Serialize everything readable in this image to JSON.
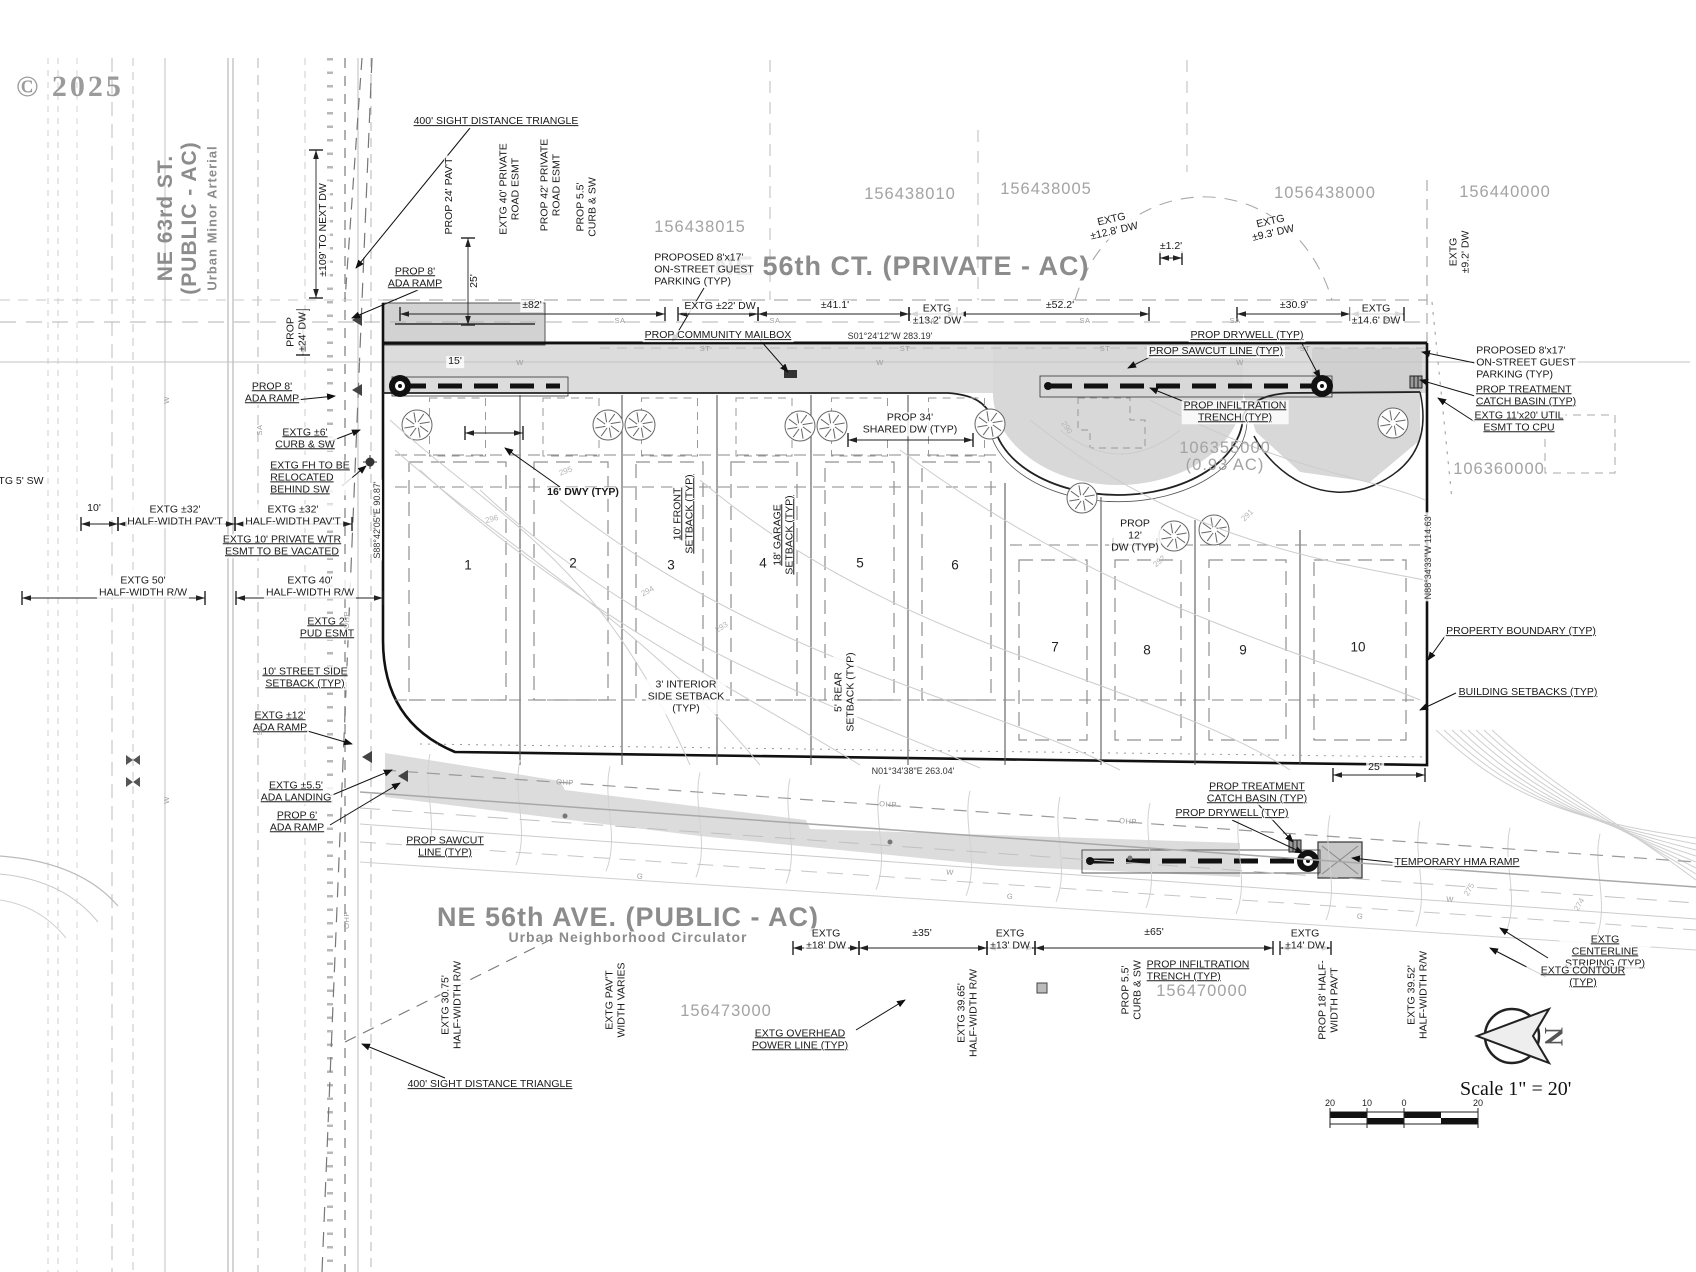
{
  "drawing": {
    "copyright": "© 2025",
    "scale_text": "Scale  1\" = 20'",
    "north_letter": "N"
  },
  "street_labels": [
    {
      "t": "NE 63rd ST.",
      "x": 166,
      "y": 218,
      "r": -90,
      "s": 21
    },
    {
      "t": "(PUBLIC - AC)",
      "x": 190,
      "y": 218,
      "r": -90,
      "s": 21
    },
    {
      "t": "Urban Minor Arterial",
      "x": 213,
      "y": 218,
      "r": -90,
      "s": 13
    },
    {
      "t": "NE 56th CT. (PRIVATE - AC)",
      "x": 902,
      "y": 266,
      "r": 0,
      "s": 27
    },
    {
      "t": "NE 56th AVE. (PUBLIC - AC)",
      "x": 628,
      "y": 917,
      "r": 0,
      "s": 27
    },
    {
      "t": "Urban Neighborhood Circulator",
      "x": 628,
      "y": 938,
      "r": 0,
      "s": 14
    }
  ],
  "parcel_labels": [
    {
      "t": "156438015",
      "x": 700,
      "y": 227
    },
    {
      "t": "156438010",
      "x": 910,
      "y": 194
    },
    {
      "t": "156438005",
      "x": 1046,
      "y": 189
    },
    {
      "t": "1056438000",
      "x": 1325,
      "y": 193
    },
    {
      "t": "156440000",
      "x": 1505,
      "y": 192
    },
    {
      "t": "106355000",
      "x": 1225,
      "y": 448
    },
    {
      "t": "(0.93 AC)",
      "x": 1225,
      "y": 465
    },
    {
      "t": "106360000",
      "x": 1499,
      "y": 469
    },
    {
      "t": "156473000",
      "x": 726,
      "y": 1011
    },
    {
      "t": "156470000",
      "x": 1202,
      "y": 991
    }
  ],
  "lot_labels": [
    {
      "t": "1",
      "x": 468,
      "y": 565
    },
    {
      "t": "2",
      "x": 573,
      "y": 563
    },
    {
      "t": "3",
      "x": 671,
      "y": 565
    },
    {
      "t": "4",
      "x": 763,
      "y": 563
    },
    {
      "t": "5",
      "x": 860,
      "y": 563
    },
    {
      "t": "6",
      "x": 955,
      "y": 565
    },
    {
      "t": "7",
      "x": 1055,
      "y": 647
    },
    {
      "t": "8",
      "x": 1147,
      "y": 650
    },
    {
      "t": "9",
      "x": 1243,
      "y": 650
    },
    {
      "t": "10",
      "x": 1358,
      "y": 647
    }
  ],
  "bearing_labels": [
    {
      "t": "S01°24'12\"W 283.19'",
      "x": 890,
      "y": 336,
      "r": 0
    },
    {
      "t": "S88°42'05\"E 90.87'",
      "x": 377,
      "y": 520,
      "r": -90
    },
    {
      "t": "N88°34'33\"W 114.63'",
      "x": 1428,
      "y": 557,
      "r": -90
    },
    {
      "t": "N01°34'38\"E 263.04'",
      "x": 913,
      "y": 771,
      "r": 0
    }
  ],
  "callout_labels": [
    {
      "t": "400' SIGHT DISTANCE TRIANGLE",
      "x": 496,
      "y": 122,
      "u": 1
    },
    {
      "t": "PROP 24' PAV'T",
      "x": 450,
      "y": 196,
      "r": -90
    },
    {
      "t": "EXTG 40' PRIVATE\nROAD ESMT",
      "x": 510,
      "y": 189,
      "r": -90
    },
    {
      "t": "PROP 42' PRIVATE\nROAD ESMT",
      "x": 551,
      "y": 185,
      "r": -90
    },
    {
      "t": "PROP 5.5'\nCURB & SW",
      "x": 587,
      "y": 207,
      "r": -90
    },
    {
      "t": "±109' TO NEXT DW",
      "x": 324,
      "y": 230,
      "r": -90
    },
    {
      "t": "PROP\n±24' DW",
      "x": 297,
      "y": 332,
      "r": -90
    },
    {
      "t": "PROP 8'\nADA RAMP",
      "x": 415,
      "y": 278,
      "u": 1
    },
    {
      "t": "PROPOSED 8'x17'\nON-STREET GUEST\nPARKING (TYP)",
      "x": 704,
      "y": 270,
      "a": "l"
    },
    {
      "t": "PROP COMMUNITY MAILBOX",
      "x": 718,
      "y": 336,
      "u": 1
    },
    {
      "t": "PROP DRYWELL (TYP)",
      "x": 1247,
      "y": 336,
      "u": 1
    },
    {
      "t": "PROP SAWCUT LINE (TYP)",
      "x": 1216,
      "y": 352,
      "u": 1
    },
    {
      "t": "PROP INFILTRATION\nTRENCH (TYP)",
      "x": 1235,
      "y": 412,
      "u": 1
    },
    {
      "t": "PROPOSED 8'x17'\nON-STREET GUEST\nPARKING (TYP)",
      "x": 1526,
      "y": 363,
      "a": "l"
    },
    {
      "t": "PROP TREATMENT\nCATCH BASIN (TYP)",
      "x": 1526,
      "y": 396,
      "u": 1,
      "a": "l"
    },
    {
      "t": "EXTG 11'x20' UTIL\nESMT TO CPU",
      "x": 1519,
      "y": 422,
      "u": 1
    },
    {
      "t": "PROP 8'\nADA RAMP",
      "x": 272,
      "y": 393,
      "u": 1
    },
    {
      "t": "EXTG ±6'\nCURB & SW",
      "x": 305,
      "y": 439,
      "u": 1
    },
    {
      "t": "TG 5' SW",
      "x": 21,
      "y": 482
    },
    {
      "t": "EXTG FH TO BE\nRELOCATED\nBEHIND SW",
      "x": 310,
      "y": 478,
      "u": 1,
      "a": "l"
    },
    {
      "t": "EXTG ±32'\nHALF-WIDTH PAV'T",
      "x": 175,
      "y": 516
    },
    {
      "t": "EXTG ±32'\nHALF-WIDTH PAV'T",
      "x": 293,
      "y": 516
    },
    {
      "t": "EXTG 10' PRIVATE WTR\nESMT TO BE VACATED",
      "x": 282,
      "y": 546,
      "u": 1
    },
    {
      "t": "EXTG 50'\nHALF-WIDTH R/W",
      "x": 143,
      "y": 587
    },
    {
      "t": "EXTG 40'\nHALF-WIDTH R/W",
      "x": 310,
      "y": 587
    },
    {
      "t": "EXTG 2'\nPUD ESMT",
      "x": 327,
      "y": 628,
      "u": 1
    },
    {
      "t": "10' STREET SIDE\nSETBACK (TYP)",
      "x": 305,
      "y": 678,
      "u": 1
    },
    {
      "t": "EXTG ±12'\nADA RAMP",
      "x": 280,
      "y": 722,
      "u": 1
    },
    {
      "t": "EXTG ±5.5'\nADA LANDING",
      "x": 296,
      "y": 792,
      "u": 1
    },
    {
      "t": "PROP 6'\nADA RAMP",
      "x": 297,
      "y": 822,
      "u": 1
    },
    {
      "t": "PROP SAWCUT\nLINE (TYP)",
      "x": 445,
      "y": 847,
      "u": 1
    },
    {
      "t": "16' DWY (TYP)",
      "x": 583,
      "y": 493,
      "b": 1
    },
    {
      "t": "10' FRONT\nSETBACK (TYP)",
      "x": 684,
      "y": 514,
      "r": -90,
      "u": 1
    },
    {
      "t": "18' GARAGE\nSETBACK (TYP)",
      "x": 784,
      "y": 535,
      "r": -90,
      "u": 1
    },
    {
      "t": "PROP 34'\nSHARED DW (TYP)",
      "x": 910,
      "y": 424
    },
    {
      "t": "3' INTERIOR\nSIDE SETBACK\n(TYP)",
      "x": 686,
      "y": 697
    },
    {
      "t": "5' REAR\nSETBACK (TYP)",
      "x": 845,
      "y": 692,
      "r": -90
    },
    {
      "t": "PROP\n12'\nDW (TYP)",
      "x": 1135,
      "y": 536
    },
    {
      "t": "PROPERTY BOUNDARY (TYP)",
      "x": 1521,
      "y": 632,
      "u": 1
    },
    {
      "t": "BUILDING SETBACKS (TYP)",
      "x": 1528,
      "y": 693,
      "u": 1
    },
    {
      "t": "PROP TREATMENT\nCATCH BASIN (TYP)",
      "x": 1257,
      "y": 793,
      "u": 1
    },
    {
      "t": "PROP DRYWELL (TYP)",
      "x": 1232,
      "y": 814,
      "u": 1
    },
    {
      "t": "TEMPORARY HMA RAMP",
      "x": 1457,
      "y": 863,
      "u": 1
    },
    {
      "t": "PROP 5.5'\nCURB & SW",
      "x": 1132,
      "y": 990,
      "r": -90
    },
    {
      "t": "PROP INFILTRATION\nTRENCH (TYP)",
      "x": 1198,
      "y": 971,
      "u": 1,
      "a": "l"
    },
    {
      "t": "PROP 18' HALF-\nWIDTH PAV'T",
      "x": 1329,
      "y": 1000,
      "r": -90
    },
    {
      "t": "EXTG 39.52'\nHALF-WIDTH R/W",
      "x": 1418,
      "y": 995,
      "r": -90
    },
    {
      "t": "EXTG 39.65'\nHALF-WIDTH R/W",
      "x": 968,
      "y": 1013,
      "r": -90
    },
    {
      "t": "EXTG 30.75'\nHALF-WIDTH R/W",
      "x": 452,
      "y": 1005,
      "r": -90
    },
    {
      "t": "EXTG PAV'T\nWIDTH VARIES",
      "x": 616,
      "y": 1000,
      "r": -90
    },
    {
      "t": "EXTG OVERHEAD\nPOWER LINE (TYP)",
      "x": 800,
      "y": 1040,
      "u": 1
    },
    {
      "t": "EXTG CENTERLINE\nSTRIPING (TYP)",
      "x": 1605,
      "y": 952,
      "u": 1
    },
    {
      "t": "EXTG CONTOUR (TYP)",
      "x": 1583,
      "y": 977,
      "u": 1
    },
    {
      "t": "400' SIGHT DISTANCE TRIANGLE",
      "x": 490,
      "y": 1085,
      "u": 1
    }
  ],
  "dim_labels": [
    {
      "t": "±82'",
      "x": 532,
      "y": 306
    },
    {
      "t": "EXTG ±22' DW",
      "x": 720,
      "y": 307
    },
    {
      "t": "±41.1'",
      "x": 835,
      "y": 306
    },
    {
      "t": "EXTG\n±13.2' DW",
      "x": 937,
      "y": 315
    },
    {
      "t": "±52.2'",
      "x": 1060,
      "y": 306
    },
    {
      "t": "EXTG\n±12.8' DW",
      "x": 1113,
      "y": 226,
      "r": -13
    },
    {
      "t": "±1.2'",
      "x": 1171,
      "y": 247
    },
    {
      "t": "EXTG\n±9.3' DW",
      "x": 1272,
      "y": 228,
      "r": -13
    },
    {
      "t": "EXTG\n±9.2' DW",
      "x": 1460,
      "y": 252,
      "r": -90
    },
    {
      "t": "±30.9'",
      "x": 1294,
      "y": 306
    },
    {
      "t": "EXTG\n±14.6' DW",
      "x": 1376,
      "y": 315
    },
    {
      "t": "25'",
      "x": 475,
      "y": 281,
      "r": -90
    },
    {
      "t": "15'",
      "x": 455,
      "y": 362
    },
    {
      "t": "10'",
      "x": 94,
      "y": 509
    },
    {
      "t": "25'",
      "x": 1375,
      "y": 768
    },
    {
      "t": "EXTG\n±18' DW",
      "x": 826,
      "y": 940
    },
    {
      "t": "±35'",
      "x": 922,
      "y": 934
    },
    {
      "t": "EXTG\n±13' DW",
      "x": 1010,
      "y": 940
    },
    {
      "t": "±65'",
      "x": 1154,
      "y": 933
    },
    {
      "t": "EXTG\n±14' DW",
      "x": 1305,
      "y": 940
    }
  ],
  "scale_tick_labels": [
    {
      "t": "20",
      "x": 1330,
      "y": 1103
    },
    {
      "t": "10",
      "x": 1367,
      "y": 1103
    },
    {
      "t": "0",
      "x": 1404,
      "y": 1103
    },
    {
      "t": "20",
      "x": 1478,
      "y": 1103
    }
  ],
  "contour_labels": [
    {
      "t": "295",
      "x": 566,
      "y": 472,
      "r": -20
    },
    {
      "t": "296",
      "x": 492,
      "y": 520,
      "r": -15
    },
    {
      "t": "294",
      "x": 648,
      "y": 592,
      "r": -28
    },
    {
      "t": "293",
      "x": 722,
      "y": 628,
      "r": -32
    },
    {
      "t": "292",
      "x": 1160,
      "y": 562,
      "r": -40
    },
    {
      "t": "291",
      "x": 1248,
      "y": 516,
      "r": -45
    },
    {
      "t": "290",
      "x": 1066,
      "y": 428,
      "r": 55
    },
    {
      "t": "275",
      "x": 1470,
      "y": 890,
      "r": -60
    },
    {
      "t": "274",
      "x": 1580,
      "y": 905,
      "r": -60
    }
  ],
  "utility_labels": [
    {
      "t": "SA",
      "x": 620,
      "y": 321
    },
    {
      "t": "SA",
      "x": 775,
      "y": 321
    },
    {
      "t": "SA",
      "x": 930,
      "y": 321
    },
    {
      "t": "SA",
      "x": 1085,
      "y": 321
    },
    {
      "t": "SA",
      "x": 1235,
      "y": 321
    },
    {
      "t": "SA",
      "x": 1390,
      "y": 321
    },
    {
      "t": "ST",
      "x": 705,
      "y": 349
    },
    {
      "t": "ST",
      "x": 905,
      "y": 349
    },
    {
      "t": "ST",
      "x": 1105,
      "y": 349
    },
    {
      "t": "ST",
      "x": 1305,
      "y": 349
    },
    {
      "t": "W",
      "x": 520,
      "y": 363
    },
    {
      "t": "W",
      "x": 880,
      "y": 363
    },
    {
      "t": "W",
      "x": 1240,
      "y": 363
    },
    {
      "t": "OHP",
      "x": 565,
      "y": 783,
      "r": 4
    },
    {
      "t": "OHP",
      "x": 888,
      "y": 805,
      "r": 4
    },
    {
      "t": "OHP",
      "x": 1128,
      "y": 822,
      "r": 4
    },
    {
      "t": "OHP",
      "x": 347,
      "y": 620,
      "r": -90
    },
    {
      "t": "OHP",
      "x": 347,
      "y": 920,
      "r": -90
    },
    {
      "t": "G",
      "x": 640,
      "y": 877,
      "r": 4
    },
    {
      "t": "G",
      "x": 1010,
      "y": 897,
      "r": 4
    },
    {
      "t": "G",
      "x": 1360,
      "y": 917,
      "r": 4
    },
    {
      "t": "W",
      "x": 950,
      "y": 873,
      "r": 4
    },
    {
      "t": "W",
      "x": 1450,
      "y": 900,
      "r": 4
    },
    {
      "t": "W",
      "x": 167,
      "y": 400,
      "r": -90
    },
    {
      "t": "W",
      "x": 167,
      "y": 800,
      "r": -90
    },
    {
      "t": "SA",
      "x": 260,
      "y": 430,
      "r": -90
    },
    {
      "t": "SA",
      "x": 260,
      "y": 730,
      "r": -90
    }
  ]
}
